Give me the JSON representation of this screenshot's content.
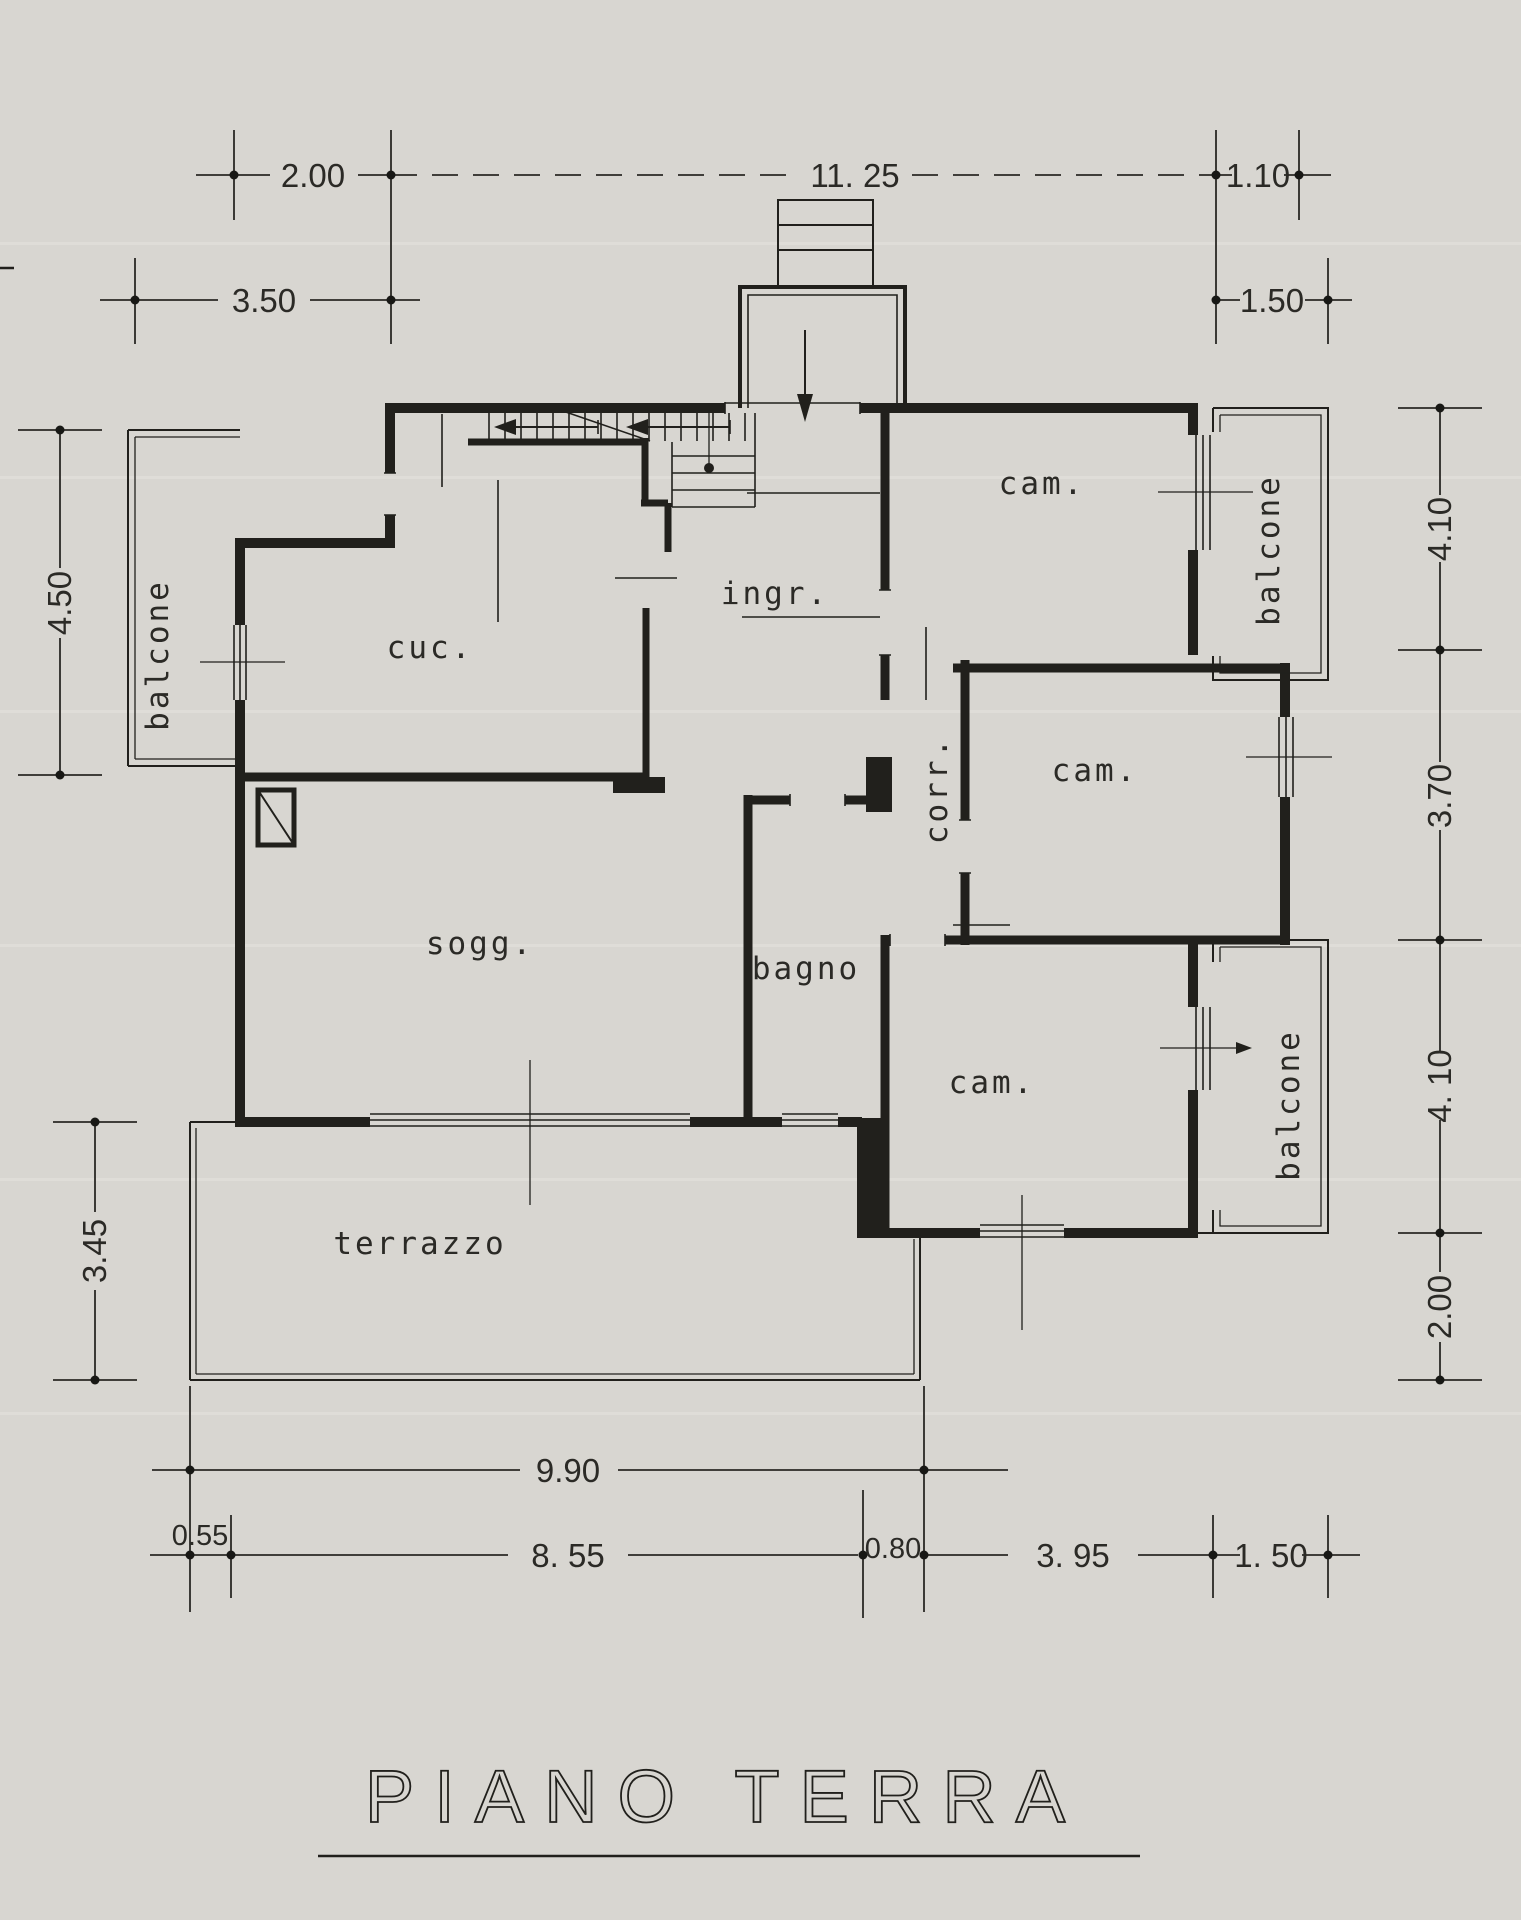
{
  "page": {
    "background": "#d8d6d1",
    "ink": "#21201c"
  },
  "title": {
    "text": "PIANO TERRA"
  },
  "rooms": {
    "balcone_left": "balcone",
    "cucina": "cuc.",
    "ingresso": "ingr.",
    "camera_top": "cam.",
    "camera_middle": "cam.",
    "camera_bottom": "cam.",
    "corridoio": "corr.",
    "soggiorno": "sogg.",
    "bagno": "bagno",
    "terrazzo": "terrazzo",
    "balcone_top_right": "balcone",
    "balcone_bottom_right": "balcone"
  },
  "dims": {
    "top_200": "2.00",
    "top_1125": "11. 25",
    "top_110": "1.10",
    "top_350": "3.50",
    "top_150": "1.50",
    "left_450": "4.50",
    "left_345": "3.45",
    "right_410a": "4.10",
    "right_370": "3.70",
    "right_410b": "4. 10",
    "right_200": "2.00",
    "bottom_990": "9.90",
    "bottom_055": "0.55",
    "bottom_855": "8. 55",
    "bottom_080": "0.80",
    "bottom_395": "3. 95",
    "bottom_150": "1. 50"
  }
}
